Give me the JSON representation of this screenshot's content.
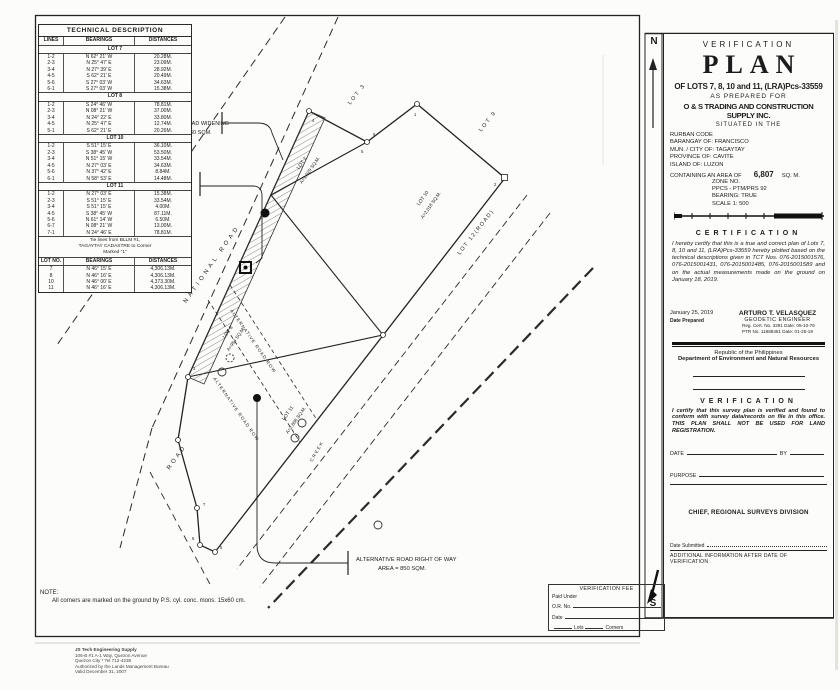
{
  "tech_table": {
    "title": "TECHNICAL DESCRIPTION",
    "columns": [
      "LINES",
      "BEARINGS",
      "DISTANCES"
    ],
    "lots": [
      {
        "name": "LOT 7",
        "rows": [
          [
            "1-2",
            "N 62° 21' W",
            "20.28M."
          ],
          [
            "2-3",
            "N 25° 47' E",
            "23.09M."
          ],
          [
            "3-4",
            "N 27° 39' E",
            "28.92M."
          ],
          [
            "4-5",
            "S 62° 21' E",
            "20.49M."
          ],
          [
            "5-6",
            "S 27° 03' W",
            "34.63M."
          ],
          [
            "6-1",
            "S 27° 03' W",
            "15.38M."
          ]
        ]
      },
      {
        "name": "LOT 8",
        "rows": [
          [
            "1-2",
            "S 24° 46' W",
            "78.81M."
          ],
          [
            "2-3",
            "N 08° 21' W",
            "37.00M."
          ],
          [
            "3-4",
            "N 24° 22' E",
            "33.80M."
          ],
          [
            "4-5",
            "N 25° 47' E",
            "12.74M."
          ],
          [
            "5-1",
            "S 62° 21' E",
            "20.26M."
          ]
        ]
      },
      {
        "name": "LOT 10",
        "rows": [
          [
            "1-2",
            "S 51° 15' E",
            "36.10M."
          ],
          [
            "2-3",
            "S 38° 45' W",
            "53.50M."
          ],
          [
            "3-4",
            "N 51° 15' W",
            "33.54M."
          ],
          [
            "4-5",
            "N 27° 03' E",
            "34.63M."
          ],
          [
            "5-6",
            "N 37° 42' E",
            "8.84M."
          ],
          [
            "6-1",
            "N 58° 53' E",
            "14.48M."
          ]
        ]
      },
      {
        "name": "LOT 11",
        "rows": [
          [
            "1-2",
            "N 27° 03' E",
            "15.38M."
          ],
          [
            "2-3",
            "S 51° 15' E",
            "33.54M."
          ],
          [
            "3-4",
            "S 51° 15' E",
            "4.00M."
          ],
          [
            "4-5",
            "S 38° 45' W",
            "87.11M."
          ],
          [
            "5-6",
            "N 61° 14' W",
            "6.50M."
          ],
          [
            "6-7",
            "N 08° 21' W",
            "13.00M."
          ],
          [
            "7-1",
            "N 24° 46' E",
            "78.81M."
          ]
        ]
      }
    ],
    "tie_note_lines": [
      "Tie lines from BLLM #1,",
      "TAGAYTAY CADASTRE   to Corner",
      "Marked \"1\""
    ],
    "tie_columns": [
      "LOT NO.",
      "BEARINGS",
      "DISTANCES"
    ],
    "tie_rows": [
      [
        "7",
        "N 46° 15' E",
        "4,306.13M."
      ],
      [
        "8",
        "N 46° 16' E",
        "4,306.13M."
      ],
      [
        "10",
        "N 46° 00' E",
        "4,373.30M."
      ],
      [
        "11",
        "N 46° 16' E",
        "4,306.13M."
      ]
    ]
  },
  "map": {
    "north": "N",
    "south": "S",
    "national_road": "NATIONAL ROAD",
    "road": "ROAD",
    "lot3": "LOT 3",
    "lot9": "LOT 9",
    "lot12": "LOT 12(ROAD)",
    "creek": "CREEK",
    "widening_1": "NATIONAL ROAD WIDENING",
    "widening_2": "AREA = 460 SQM.",
    "existing_1": "EXISTING STRUCTURE",
    "existing_2": "(OCAMPO'S RESIDENCE)",
    "existing_3": "AREA = 19 SQM.",
    "alt_row": "ALTERNATIVE ROAD ROW",
    "alt_right_1": "ALTERNATIVE ROAD RIGHT OF WAY",
    "alt_right_2": "AREA = 850 SQM.",
    "lot7_1": "LOT 7",
    "lot7_2": "A=1,029 SQ.M.",
    "lot8_1": "LOT 8",
    "lot8_2": "A=954 SQ.M.",
    "lot10_1": "LOT 10",
    "lot10_2": "A=2,018 SQ.M.",
    "lot11_1": "LOT 11",
    "lot11_2": "A=2,806 SQ.M.",
    "corners": {
      "c1": "1",
      "c2": "2",
      "c3": "3",
      "c4": "4",
      "c5": "5",
      "c6": "6",
      "c7": "7"
    },
    "note_title": "NOTE:",
    "note_body": "All corners are marked on the ground by P.S. cyl. conc. mons. 15x60 cm."
  },
  "title_block": {
    "verification": "VERIFICATION",
    "plan": "PLAN",
    "of_lots": "OF LOTS 7, 8, 10 and 11, (LRA)Pcs-33559",
    "as_prepared": "AS PREPARED FOR",
    "company": "O & S TRADING AND CONSTRUCTION SUPPLY INC.",
    "situated": "SITUATED IN THE",
    "fields": [
      "RURBAN CODE",
      "BARANGAY OF:  FRANCISCO",
      "MUN. / CITY OF:  TAGAYTAY",
      "PROVINCE OF:  CAVITE",
      "ISLAND OF:  LUZON"
    ],
    "area_label": "CONTAINING AN AREA OF",
    "area_value": "6,807",
    "area_unit": "SQ. M.",
    "zone_lines": [
      "ZONE NO.",
      "PPCS - PTM/PRS 92",
      "BEARING: TRUE",
      "SCALE 1: 500"
    ]
  },
  "certification": {
    "heading": "CERTIFICATION",
    "body": "I hereby certify that this is a true and correct plan of Lots 7, 8, 10 and 11, (LRA)Pcs-33559 hereby plotted based on the technical descriptions given in TCT Nos. 076-2015001576, 076-2015001431, 076-2015001485, 076-2015001589 and on the actual measurements made on the ground on January 18, 2019.",
    "date": "January 25, 2019",
    "date_label": "Date Prepared",
    "engineer": "ARTURO T. VELASQUEZ",
    "engineer_title": "GEODETIC ENGINEER",
    "reg_line": "Reg. Cert. No. 3291      Date: 05-10-76",
    "ptr_line": "PTR No. 11888451      Date: 01-25-19"
  },
  "denr": {
    "republic": "Republic of the Philippines",
    "department": "Department of Environment and Natural Resources",
    "heading": "VERIFICATION",
    "body": "I certify that this survey plan is verified and found to conform with survey data/records on file in this office. THIS PLAN SHALL NOT BE USED FOR LAND REGISTRATION.",
    "date_label": "DATE",
    "by_label": "BY",
    "purpose_label": "PURPOSE",
    "chief": "CHIEF, REGIONAL SURVEYS DIVISION",
    "date_submitted": "Date Submitted",
    "additional": "ADDITIONAL INFORMATION AFTER DATE OF VERIFICATION"
  },
  "fee_box": {
    "title": "VERIFICATION FEE",
    "paid_under": "Paid Under",
    "or_label": "O.R. No.",
    "date_label": "Date",
    "lots_label": "Lots",
    "corners_label": "Corners"
  },
  "credits": {
    "lines": [
      "JS Tech Engineering Supply",
      "106-B #1 A-1 Way, Quezon Avenue",
      "Quezon City * Tel 712-4238",
      "Authorized by the Lands Management Bureau",
      "Valid December 31, 2007"
    ]
  }
}
